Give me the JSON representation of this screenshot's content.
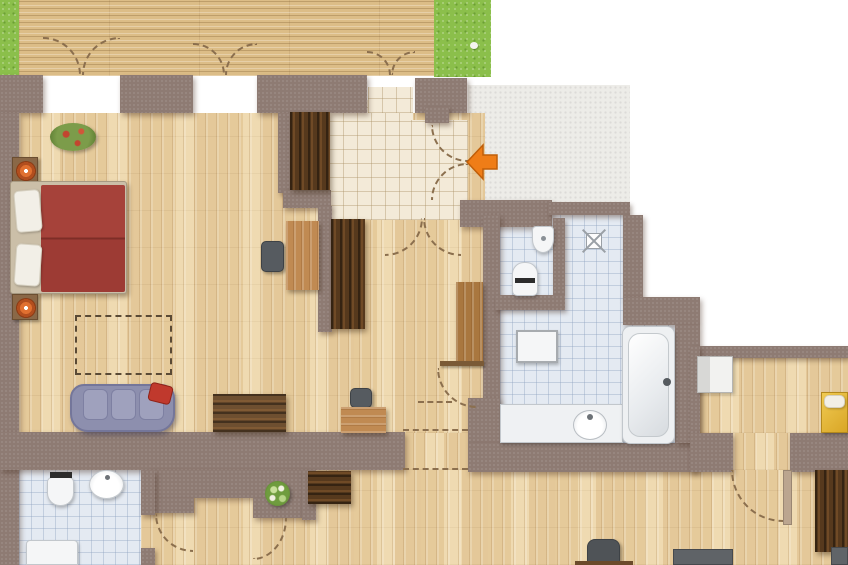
{
  "title": "apartment-floor-plan",
  "palette": {
    "wall": "#8e7b73",
    "deck": "#dcbd87",
    "grass": "#8bbf4b",
    "tilebath": "#e4eaf2",
    "tilehall": "#f3ead8",
    "concrete": "#edece8",
    "darkwood": "#56391d",
    "midwood": "#c08a52",
    "bedred": "#9d3b34",
    "sofablue": "#8d8fae",
    "accent": "#ef7d17",
    "dash": "#8b6f4e",
    "yellow": "#e5b637",
    "fixture": "#f5f6f7"
  },
  "entry": {
    "arrow_direction": "left"
  },
  "labels": {
    "terrace": "terrace deck",
    "lawn": "lawn",
    "bedroom_bed": "double bed",
    "nightstand": "nightstand with lamp",
    "plant": "potted plant",
    "rug": "rug outline",
    "sofa": "sofa with red cushion",
    "wardrobe": "wardrobe",
    "sideboard": "sideboard",
    "desk": "desk",
    "chair": "chair",
    "cabinet": "cabinet",
    "hall": "entrance hall",
    "entry_walkway": "entry walkway",
    "entry_arrow": "entrance arrow",
    "wc": "toilet",
    "corner_sink": "corner washbasin",
    "shower_drain": "floor drain",
    "washer": "washing machine",
    "bathtub": "bathtub",
    "vanity": "washbasin counter",
    "sink": "washbasin",
    "shower_tray": "shower tray",
    "bed_right": "bed (partial)",
    "door_swing": "door swing",
    "wall": "wall segment"
  }
}
